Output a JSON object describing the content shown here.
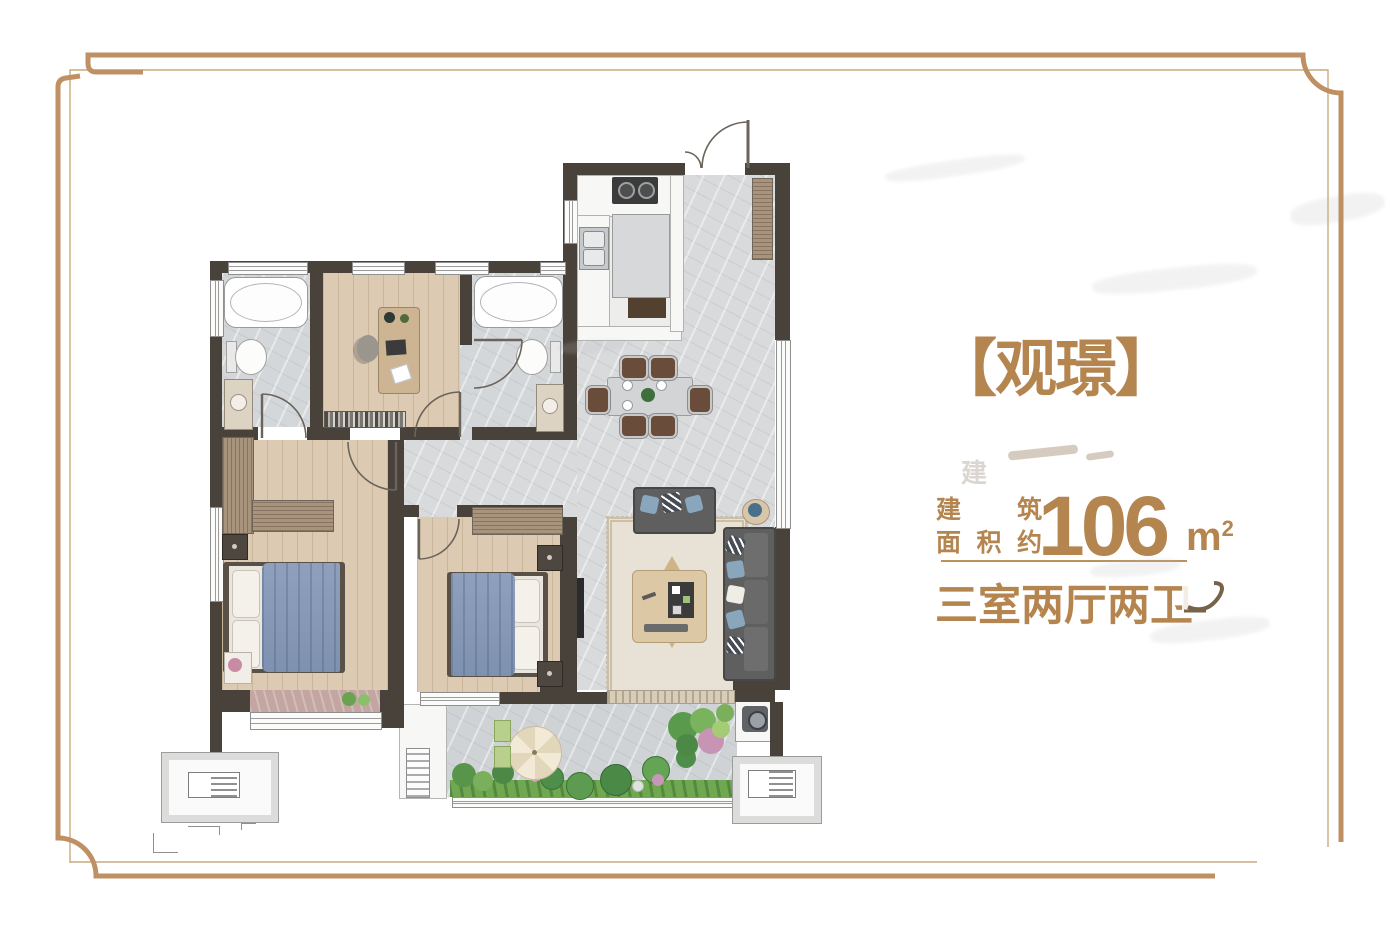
{
  "title": "【观璟】",
  "watermark_ghost": "建",
  "area": {
    "prefix_line1": "建 筑",
    "prefix_line2": "面积约",
    "value": "106",
    "unit_base": "m",
    "unit_sup": "2"
  },
  "layout_type": "三室两厅两卫",
  "colors": {
    "accent_tan": "#b5854f",
    "frame_thick": "#bf9063",
    "frame_thin": "#c9aa80",
    "wall_dark": "#49423b",
    "marble_floor": "#d8dadc",
    "wood_floor": "#dccbb2",
    "bed_blanket": "#8496b4"
  }
}
